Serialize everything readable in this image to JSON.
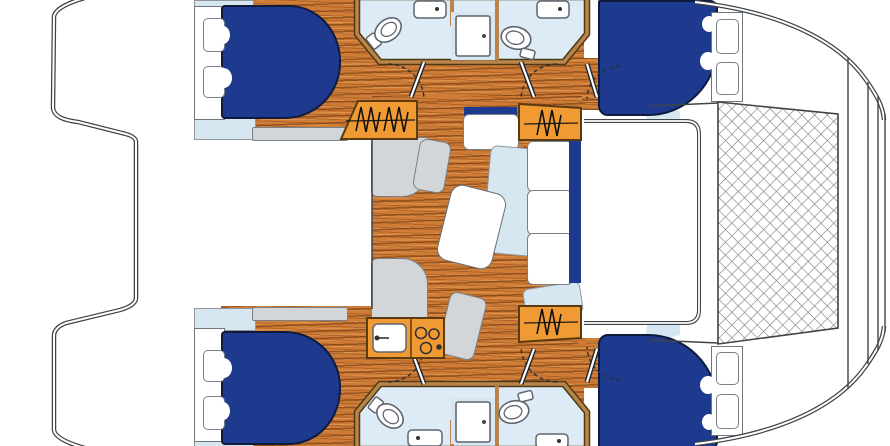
{
  "meta": {
    "title": "Catamaran yacht interior floor plan, bows to the right"
  },
  "colors": {
    "navy": "#1e3a8f",
    "pale_blue": "#d6e7f2",
    "bath_floor": "#dcebf5",
    "gray": "#d3d6d9",
    "orange": "#f09a33",
    "wood": "#cf7d36",
    "wall_tan": "#b9854a",
    "outline": "#3f4449",
    "fixture_stroke": "#5f6670",
    "net_line": "#7d838a"
  },
  "layout": {
    "hulls": 2,
    "orientation": "bows-right",
    "symmetry": "mirrored-top-bottom"
  },
  "rooms": {
    "cockpit": {
      "label": "Aft cockpit between transom steps"
    },
    "saloon": {
      "label": "Saloon with dinette seating, table and sofa"
    },
    "galley": {
      "label": "Galley block with sink and burners",
      "burners": 3
    },
    "trampoline": {
      "label": "Bow trampoline net"
    },
    "port_aft_cabin": {
      "label": "Port aft double cabin"
    },
    "port_fwd_cabin": {
      "label": "Port forward double cabin"
    },
    "stbd_aft_cabin": {
      "label": "Starboard aft double cabin"
    },
    "stbd_fwd_cabin": {
      "label": "Starboard forward double cabin"
    },
    "port_head": {
      "label": "Port head: toilet, washbasin and shower"
    },
    "stbd_head": {
      "label": "Starboard head: toilet, washbasin and shower"
    },
    "port_steps": {
      "label": "Port companionway steps"
    },
    "port_fwd_steps": {
      "label": "Port forward companionway steps"
    },
    "stbd_fwd_steps": {
      "label": "Starboard forward companionway steps"
    }
  },
  "counts": {
    "cabins": 4,
    "heads": 2,
    "toilets": 4,
    "washbasins": 4,
    "showers": 2,
    "berths": 4,
    "step_flights": 3
  }
}
